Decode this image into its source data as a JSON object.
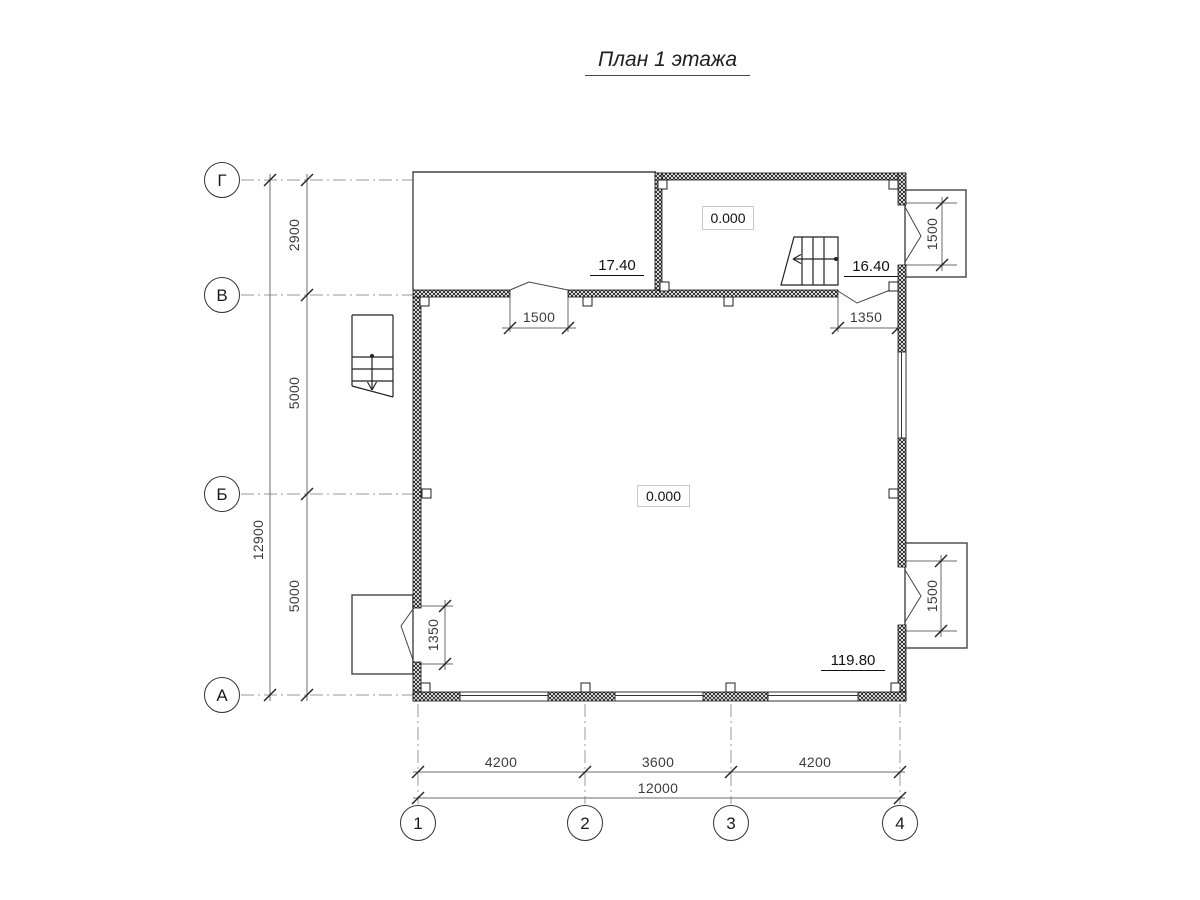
{
  "title": "План 1 этажа",
  "colors": {
    "line": "#111111",
    "thin_line": "#444444",
    "dimension": "#3c3c3c",
    "grid": "#999999"
  },
  "axes": {
    "rows": [
      {
        "label": "Г"
      },
      {
        "label": "В"
      },
      {
        "label": "Б"
      },
      {
        "label": "А"
      }
    ],
    "cols": [
      {
        "label": "1"
      },
      {
        "label": "2"
      },
      {
        "label": "3"
      },
      {
        "label": "4"
      }
    ]
  },
  "dimensions": {
    "left_segments": [
      "2900",
      "5000",
      "5000"
    ],
    "left_total": "12900",
    "bottom_segments": [
      "4200",
      "3600",
      "4200"
    ],
    "bottom_total": "12000",
    "door_b_left": "1500",
    "door_b_right": "1350",
    "door_left_wall": "1350",
    "porch_top_right": "1500",
    "porch_bottom_right": "1500"
  },
  "levels": {
    "room_top_right": "0.000",
    "room_main": "0.000"
  },
  "areas": {
    "top_left": "17.40",
    "top_right": "16.40",
    "main": "119.80"
  }
}
